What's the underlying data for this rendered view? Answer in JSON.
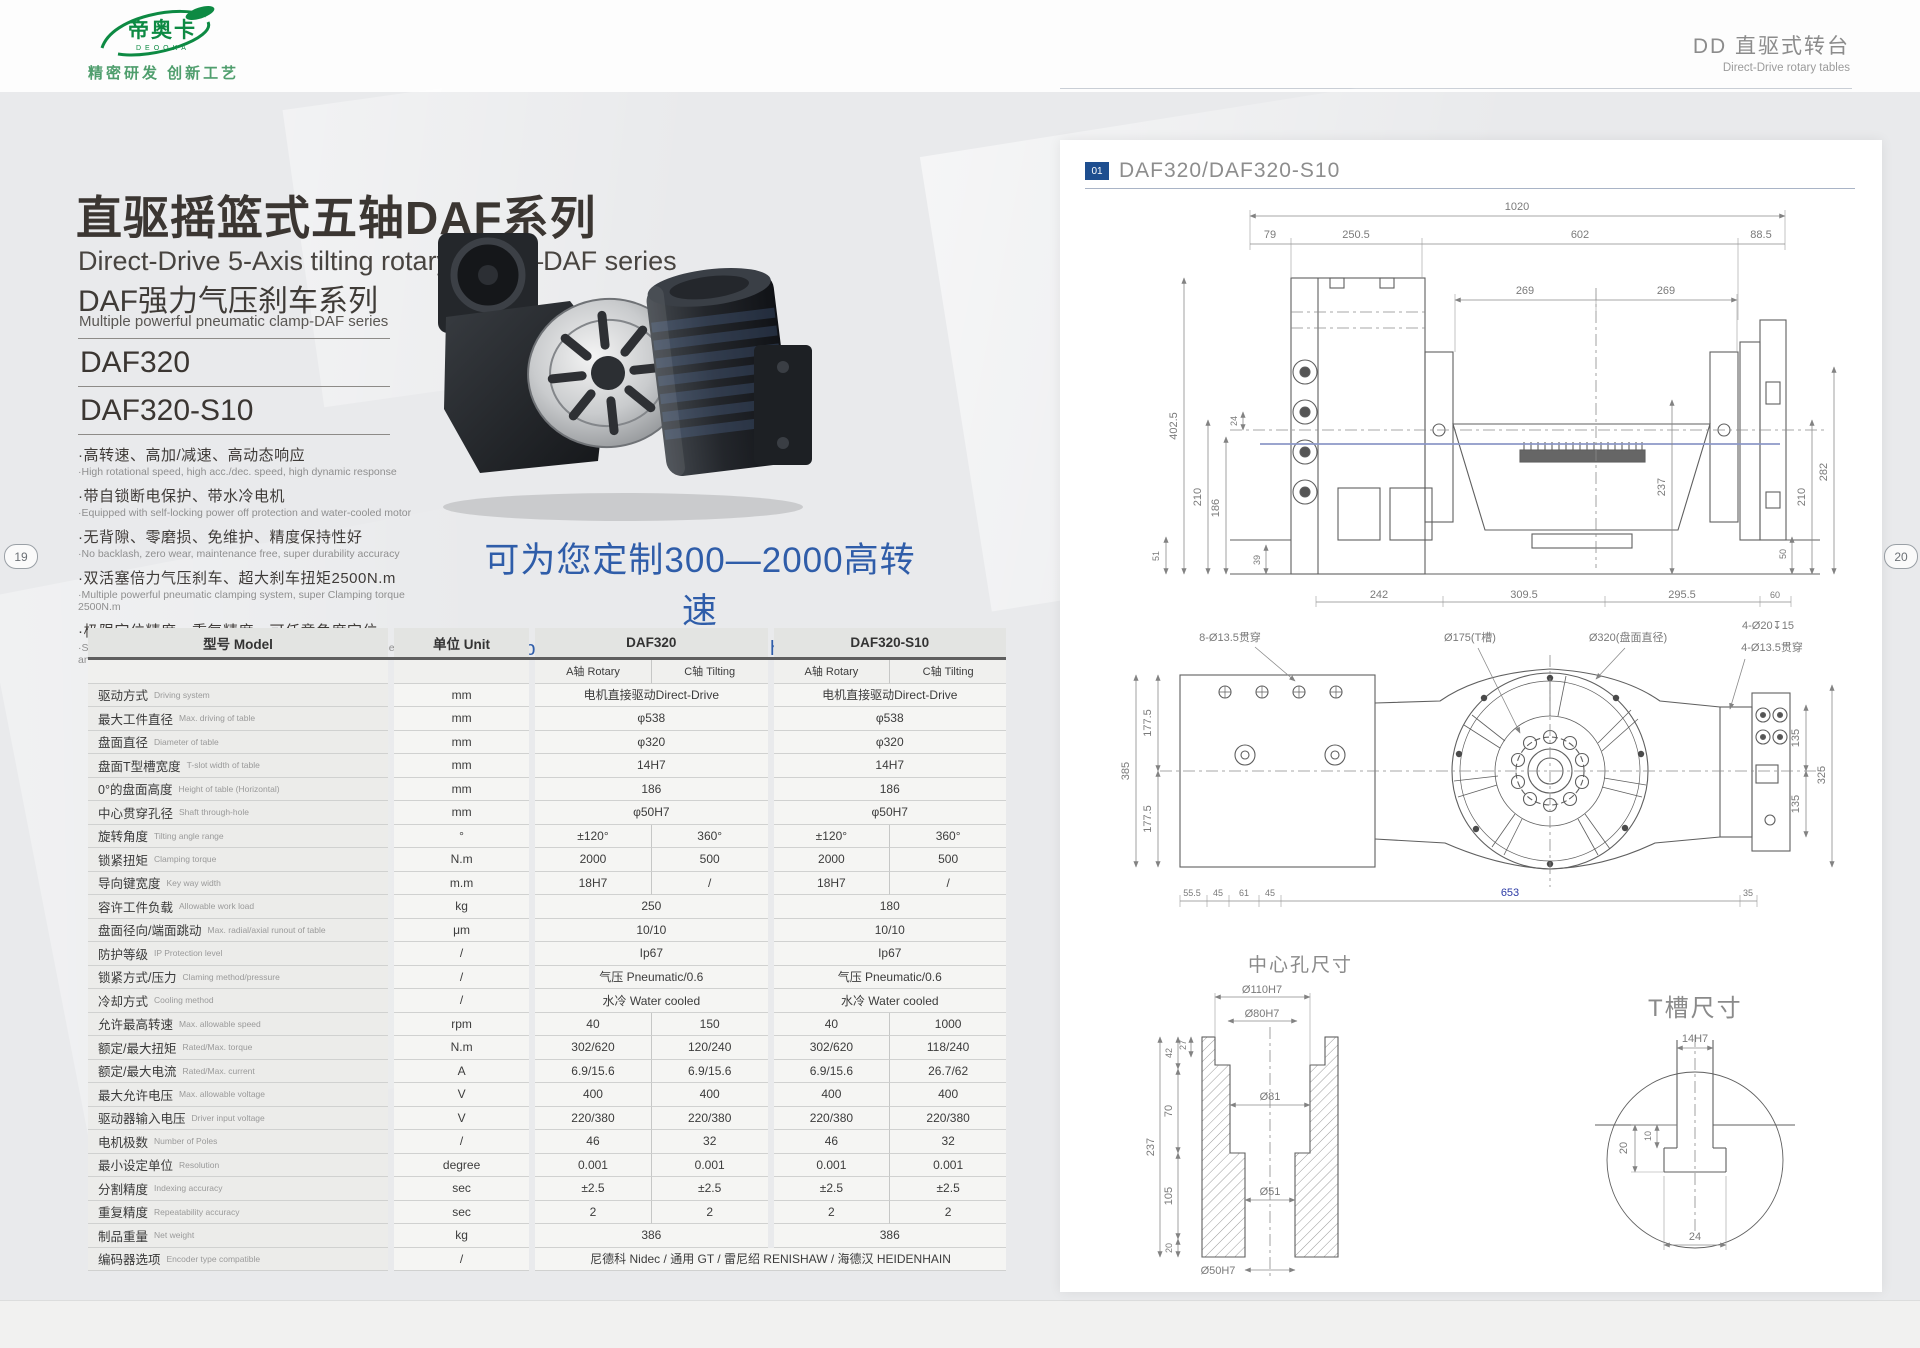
{
  "header": {
    "logo_text": "帝奥卡",
    "logo_sub": "DEOOKA",
    "tagline": "精密研发 创新工艺",
    "right_title": "DD 直驱式转台",
    "right_subtitle": "Direct-Drive rotary tables"
  },
  "page_numbers": {
    "left": "19",
    "right": "20"
  },
  "intro": {
    "title_cn": "直驱摇篮式五轴DAF系列",
    "title_en": "Direct-Drive 5-Axis tilting rotary table—DAF series",
    "series_cn": "DAF强力气压刹车系列",
    "series_en": "Multiple powerful pneumatic clamp-DAF series",
    "models": [
      "DAF320",
      "DAF320-S10"
    ],
    "features": [
      {
        "cn": "·高转速、高加/减速、高动态响应",
        "en": "·High rotational speed, high acc./dec. speed, high dynamic response"
      },
      {
        "cn": "·带自锁断电保护、带水冷电机",
        "en": "·Equipped with self-locking power off protection and water-cooled motor"
      },
      {
        "cn": "·无背隙、零磨损、免维护、精度保持性好",
        "en": "·No backlash, zero wear, maintenance free, super durability accuracy"
      },
      {
        "cn": "·双活塞倍力气压刹车、超大刹车扭矩2500N.m",
        "en": "·Multiple powerful pneumatic clamping system, super Clamping torque 2500N.m"
      },
      {
        "cn": "·极限定位精度、重复精度、可任意角度定位",
        "en": "·Super indexing accuracy, excellent repeatability accuracy, positioned at any angle"
      }
    ],
    "custom_cn": "可为您定制300—2000高转速",
    "custom_en": "(Special design for your need high rotational speed)"
  },
  "spec_table": {
    "header": {
      "model": "型号 Model",
      "unit": "单位 Unit",
      "m1": "DAF320",
      "m2": "DAF320-S10",
      "a": "A轴 Rotary",
      "c": "C轴 Tilting"
    },
    "rows": [
      {
        "cn": "驱动方式",
        "en": "Driving system",
        "unit": "mm",
        "type": "2",
        "v": [
          "电机直接驱动Direct-Drive",
          "电机直接驱动Direct-Drive"
        ]
      },
      {
        "cn": "最大工件直径",
        "en": "Max. driving of table",
        "unit": "mm",
        "type": "2",
        "v": [
          "φ538",
          "φ538"
        ]
      },
      {
        "cn": "盘面直径",
        "en": "Diameter of table",
        "unit": "mm",
        "type": "2",
        "v": [
          "φ320",
          "φ320"
        ]
      },
      {
        "cn": "盘面T型槽宽度",
        "en": "T-slot width of table",
        "unit": "mm",
        "type": "2",
        "v": [
          "14H7",
          "14H7"
        ]
      },
      {
        "cn": "0°的盘面高度",
        "en": "Height of table (Horizontal)",
        "unit": "mm",
        "type": "2",
        "v": [
          "186",
          "186"
        ]
      },
      {
        "cn": "中心贯穿孔径",
        "en": "Shaft through-hole",
        "unit": "mm",
        "type": "2",
        "v": [
          "φ50H7",
          "φ50H7"
        ]
      },
      {
        "cn": "旋转角度",
        "en": "Tilting angle range",
        "unit": "°",
        "type": "4",
        "v": [
          "±120°",
          "360°",
          "±120°",
          "360°"
        ]
      },
      {
        "cn": "锁紧扭矩",
        "en": "Clamping torque",
        "unit": "N.m",
        "type": "4",
        "v": [
          "2000",
          "500",
          "2000",
          "500"
        ]
      },
      {
        "cn": "导向键宽度",
        "en": "Key way width",
        "unit": "m.m",
        "type": "4",
        "v": [
          "18H7",
          "/",
          "18H7",
          "/"
        ]
      },
      {
        "cn": "容许工件负载",
        "en": "Allowable work load",
        "unit": "kg",
        "type": "2",
        "v": [
          "250",
          "180"
        ]
      },
      {
        "cn": "盘面径向/端面跳动",
        "en": "Max. radial/axial runout of table",
        "unit": "μm",
        "type": "2",
        "v": [
          "10/10",
          "10/10"
        ]
      },
      {
        "cn": "防护等级",
        "en": "IP Protection level",
        "unit": "/",
        "type": "2",
        "v": [
          "Ip67",
          "Ip67"
        ]
      },
      {
        "cn": "锁紧方式/压力",
        "en": "Claming method/pressure",
        "unit": "/",
        "type": "2",
        "v": [
          "气压 Pneumatic/0.6",
          "气压 Pneumatic/0.6"
        ]
      },
      {
        "cn": "冷却方式",
        "en": "Cooling method",
        "unit": "/",
        "type": "2",
        "v": [
          "水冷 Water cooled",
          "水冷 Water cooled"
        ]
      },
      {
        "cn": "允许最高转速",
        "en": "Max. allowable speed",
        "unit": "rpm",
        "type": "4",
        "v": [
          "40",
          "150",
          "40",
          "1000"
        ]
      },
      {
        "cn": "额定/最大扭矩",
        "en": "Rated/Max. torque",
        "unit": "N.m",
        "type": "4",
        "v": [
          "302/620",
          "120/240",
          "302/620",
          "118/240"
        ]
      },
      {
        "cn": "额定/最大电流",
        "en": "Rated/Max. current",
        "unit": "A",
        "type": "4",
        "v": [
          "6.9/15.6",
          "6.9/15.6",
          "6.9/15.6",
          "26.7/62"
        ]
      },
      {
        "cn": "最大允许电压",
        "en": "Max. allowable voltage",
        "unit": "V",
        "type": "4",
        "v": [
          "400",
          "400",
          "400",
          "400"
        ]
      },
      {
        "cn": "驱动器输入电压",
        "en": "Driver input voltage",
        "unit": "V",
        "type": "4",
        "v": [
          "220/380",
          "220/380",
          "220/380",
          "220/380"
        ]
      },
      {
        "cn": "电机极数",
        "en": "Number of Poles",
        "unit": "/",
        "type": "4",
        "v": [
          "46",
          "32",
          "46",
          "32"
        ]
      },
      {
        "cn": "最小设定单位",
        "en": "Resolution",
        "unit": "degree",
        "type": "4",
        "v": [
          "0.001",
          "0.001",
          "0.001",
          "0.001"
        ]
      },
      {
        "cn": "分割精度",
        "en": "Indexing accuracy",
        "unit": "sec",
        "type": "4",
        "v": [
          "±2.5",
          "±2.5",
          "±2.5",
          "±2.5"
        ]
      },
      {
        "cn": "重复精度",
        "en": "Repeatability accuracy",
        "unit": "sec",
        "type": "4",
        "v": [
          "2",
          "2",
          "2",
          "2"
        ]
      },
      {
        "cn": "制品重量",
        "en": "Net weight",
        "unit": "kg",
        "type": "2",
        "v": [
          "386",
          "386"
        ]
      },
      {
        "cn": "编码器选项",
        "en": "Encoder type compatible",
        "unit": "/",
        "type": "1",
        "v": [
          "尼德科 Nidec  /  通用 GT  /  雷尼绍 RENISHAW  /  海德汉 HEIDENHAIN"
        ]
      }
    ]
  },
  "drawings": {
    "label_index": "01",
    "label_title": "DAF320/DAF320-S10",
    "front": {
      "top": [
        "1020",
        "79",
        "250.5",
        "602",
        "88.5"
      ],
      "mid": [
        "269",
        "269"
      ],
      "left": [
        "402.5",
        "210",
        "186",
        "24"
      ],
      "bl": [
        "51",
        "39"
      ],
      "center": [
        "237"
      ],
      "right": [
        "282",
        "210",
        "50"
      ],
      "bottom": [
        "242",
        "309.5",
        "295.5",
        "60"
      ]
    },
    "plan": {
      "callouts": [
        "8-Ø13.5贯穿",
        "Ø175(T槽)",
        "Ø320(盘面直径)",
        "4-Ø20↧15",
        "4-Ø13.5贯穿"
      ],
      "left": [
        "385",
        "177.5",
        "177.5"
      ],
      "right": [
        "135",
        "135",
        "325"
      ],
      "bottom": [
        "55.5",
        "45",
        "61",
        "45",
        "653",
        "35"
      ]
    },
    "center_hole": {
      "title": "中心孔尺寸",
      "top": [
        "Ø110H7",
        "Ø80H7"
      ],
      "left": [
        "237",
        "42",
        "27",
        "70",
        "105",
        "20"
      ],
      "inner": [
        "Ø81",
        "Ø51"
      ],
      "bottom": [
        "Ø50H7"
      ]
    },
    "tslot": {
      "title": "T槽尺寸",
      "top": [
        "14H7"
      ],
      "left": [
        "20",
        "10"
      ],
      "bottom": [
        "24"
      ]
    }
  }
}
